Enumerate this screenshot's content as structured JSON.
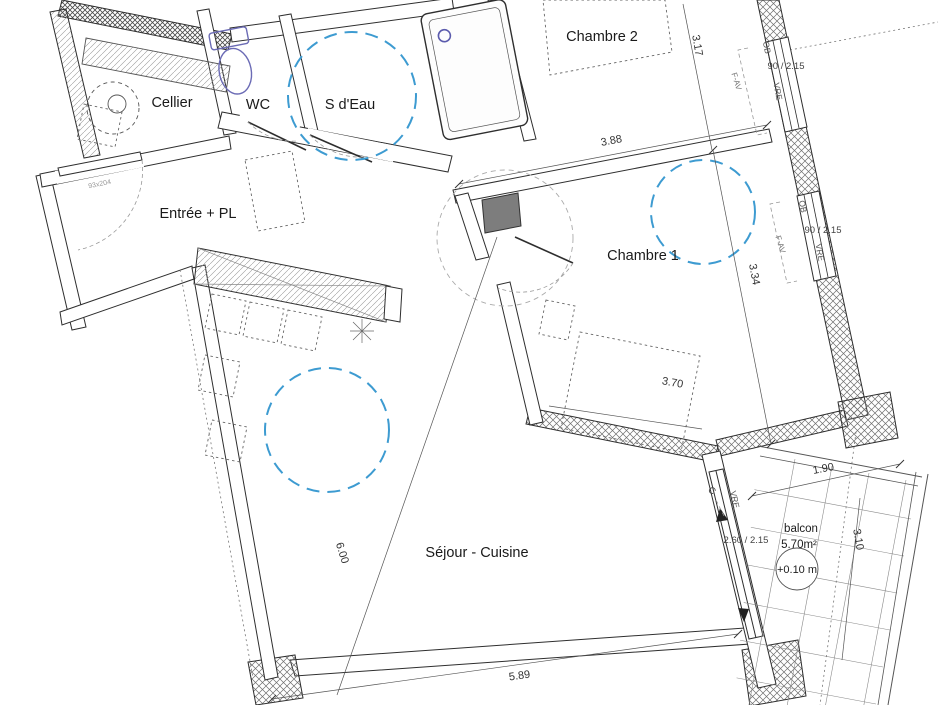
{
  "plan": {
    "labels": {
      "cellier": "Cellier",
      "wc": "WC",
      "sdeau": "S d'Eau",
      "chambre2": "Chambre 2",
      "entree": "Entrée + PL",
      "chambre1": "Chambre 1",
      "sejour": "Séjour - Cuisine",
      "balcon": "balcon",
      "balcon_area": "5.70m²",
      "balcon_level": "+0.10 m"
    },
    "dims": {
      "chambre2_depth": "3.17",
      "chambre1_width": "3.88",
      "chambre1_depth": "3.34",
      "bed_width": "3.70",
      "sejour_height": "6.00",
      "sejour_width": "5.89",
      "balcon_width": "1.90",
      "balcon_depth": "3.10"
    },
    "openings": {
      "window1": {
        "ob": "OB",
        "size": "90 / 2.15",
        "vre": "VRE",
        "fav": "F-AV"
      },
      "window2": {
        "ob": "OB",
        "size": "90 / 2.15",
        "vre": "VRE",
        "fav": "F-AV"
      },
      "balcony_door": {
        "size": "2.60 / 2.15",
        "vre": "VRE",
        "c_mark": "C"
      },
      "entry_door": {
        "size": "93x204"
      }
    },
    "colors": {
      "accessibility_circle": "#3d9bd1",
      "fixture_outline": "#6b6bb5",
      "column_fill": "#7d7d7d"
    }
  }
}
